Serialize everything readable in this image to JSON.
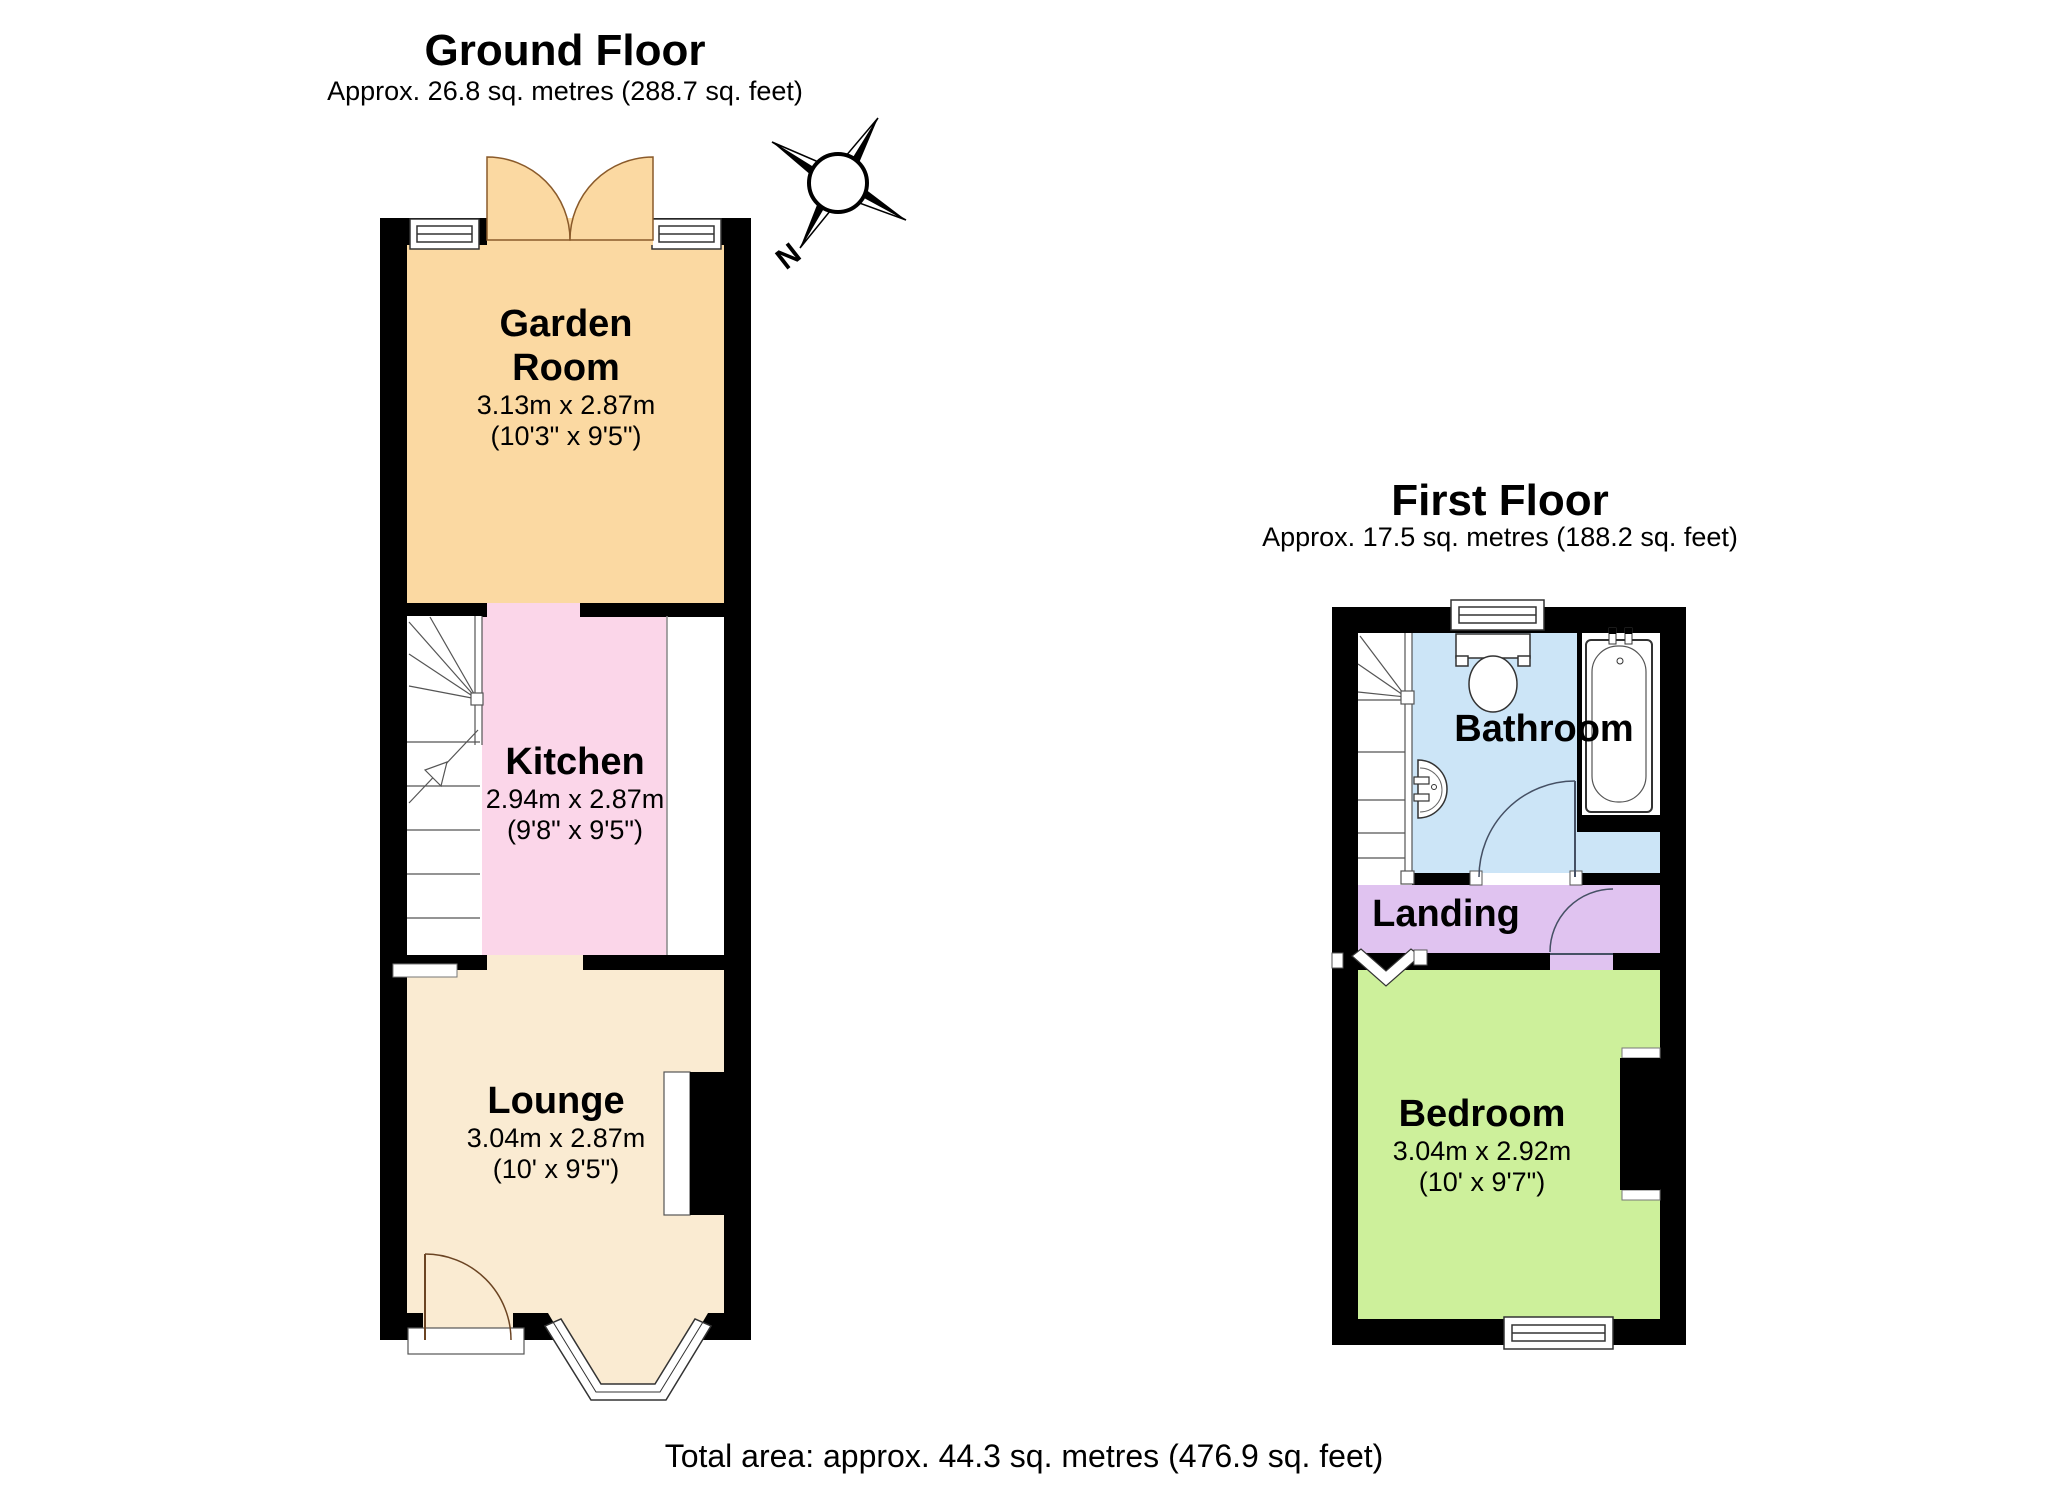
{
  "ground_floor": {
    "title": "Ground Floor",
    "subtitle": "Approx. 26.8 sq. metres (288.7 sq. feet)",
    "rooms": [
      {
        "name": "Garden\nRoom",
        "dims_metric": "3.13m x 2.87m",
        "dims_imperial": "(10'3\" x 9'5\")",
        "color": "#fbd9a2"
      },
      {
        "name": "Kitchen",
        "dims_metric": "2.94m x 2.87m",
        "dims_imperial": "(9'8\" x 9'5\")",
        "color": "#fbd6e9"
      },
      {
        "name": "Lounge",
        "dims_metric": "3.04m x 2.87m",
        "dims_imperial": "(10' x 9'5\")",
        "color": "#faebd2"
      }
    ]
  },
  "first_floor": {
    "title": "First Floor",
    "subtitle": "Approx. 17.5 sq. metres (188.2 sq. feet)",
    "rooms": [
      {
        "name": "Bathroom",
        "color": "#cce5f7"
      },
      {
        "name": "Landing",
        "color": "#e0c3f0"
      },
      {
        "name": "Bedroom",
        "dims_metric": "3.04m x 2.92m",
        "dims_imperial": "(10' x 9'7\")",
        "color": "#cdf09b"
      }
    ]
  },
  "compass": {
    "north_label": "N"
  },
  "footer": {
    "total_area": "Total area: approx. 44.3 sq. metres (476.9 sq. feet)"
  },
  "colors": {
    "wall": "#000000",
    "garden_room": "#fbd9a2",
    "kitchen": "#fbd6e9",
    "lounge": "#faebd2",
    "bathroom": "#cce5f7",
    "landing": "#e0c3f0",
    "bedroom": "#cdf09b"
  }
}
